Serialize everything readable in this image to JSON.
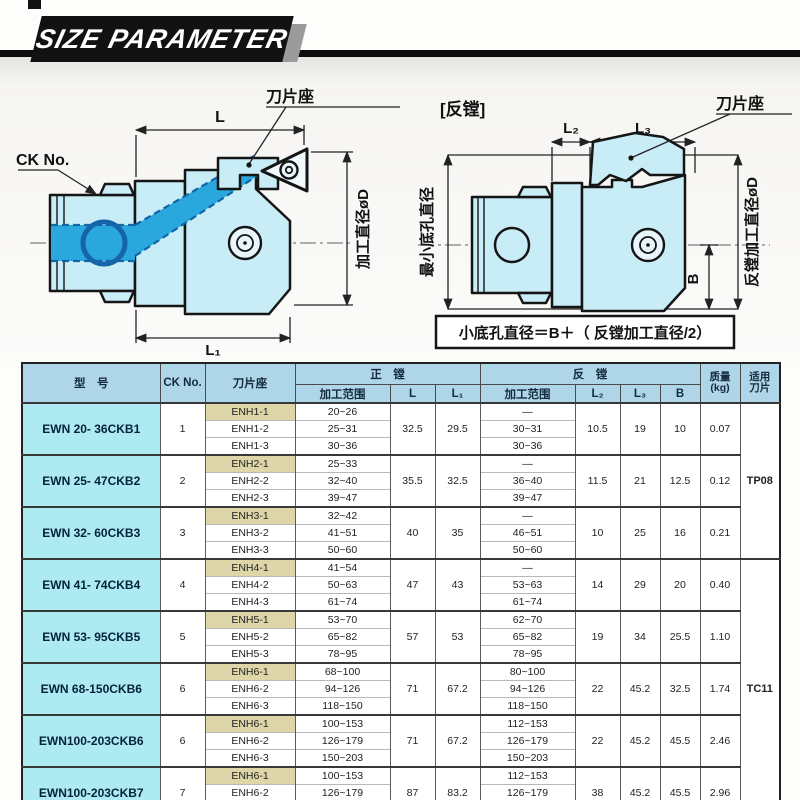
{
  "header": {
    "title": "SIZE PARAMETER"
  },
  "colors": {
    "accent_cyan": "#aeeaf2",
    "header_blue": "#aed6e8",
    "seat_tan": "#ded6a8",
    "tool_body_fill": "#c9edf7",
    "tool_highlight_blue": "#2aa7dc",
    "banner_black": "#111111"
  },
  "diagram_left": {
    "ck_label": "CK No.",
    "seat_label": "刀片座",
    "dim_l": "L",
    "dim_l1": "L₁",
    "dim_d": "加工直径øD"
  },
  "diagram_right": {
    "caption": "[反镗]",
    "dim_l2": "L₂",
    "dim_l3": "L₃",
    "seat_label": "刀片座",
    "dim_left": "最小底孔直径",
    "dim_right": "反镗加工直径øD",
    "dim_b": "B",
    "formula": "小底孔直径＝B＋（ 反镗加工直径/2）"
  },
  "table": {
    "headers": {
      "model": "型　号",
      "ck": "CK No.",
      "seat": "刀片座",
      "forward": "正　镗",
      "reverse": "反　镗",
      "range": "加工范围",
      "l": "L",
      "l1": "L₁",
      "l2": "L₂",
      "l3": "L₃",
      "b": "B",
      "weight_line1": "质量",
      "weight_line2": "(kg)",
      "insert_line1": "适用",
      "insert_line2": "刀片"
    },
    "insert_groups": [
      {
        "label": "TP08",
        "span": 3
      },
      {
        "label": "TC11",
        "span": 5
      }
    ],
    "rows": [
      {
        "model": "EWN 20- 36CKB1",
        "ck": "1",
        "seats": [
          "ENH1-1",
          "ENH1-2",
          "ENH1-3"
        ],
        "fwd": [
          "20~26",
          "25~31",
          "30~36"
        ],
        "l": "32.5",
        "l1": "29.5",
        "rev": [
          "—",
          "30~31",
          "30~36"
        ],
        "l2": "10.5",
        "l3": "19",
        "b": "10",
        "wt": "0.07"
      },
      {
        "model": "EWN 25- 47CKB2",
        "ck": "2",
        "seats": [
          "ENH2-1",
          "ENH2-2",
          "ENH2-3"
        ],
        "fwd": [
          "25~33",
          "32~40",
          "39~47"
        ],
        "l": "35.5",
        "l1": "32.5",
        "rev": [
          "—",
          "36~40",
          "39~47"
        ],
        "l2": "11.5",
        "l3": "21",
        "b": "12.5",
        "wt": "0.12"
      },
      {
        "model": "EWN 32- 60CKB3",
        "ck": "3",
        "seats": [
          "ENH3-1",
          "ENH3-2",
          "ENH3-3"
        ],
        "fwd": [
          "32~42",
          "41~51",
          "50~60"
        ],
        "l": "40",
        "l1": "35",
        "rev": [
          "—",
          "46~51",
          "50~60"
        ],
        "l2": "10",
        "l3": "25",
        "b": "16",
        "wt": "0.21"
      },
      {
        "model": "EWN 41- 74CKB4",
        "ck": "4",
        "seats": [
          "ENH4-1",
          "ENH4-2",
          "ENH4-3"
        ],
        "fwd": [
          "41~54",
          "50~63",
          "61~74"
        ],
        "l": "47",
        "l1": "43",
        "rev": [
          "—",
          "53~63",
          "61~74"
        ],
        "l2": "14",
        "l3": "29",
        "b": "20",
        "wt": "0.40"
      },
      {
        "model": "EWN 53- 95CKB5",
        "ck": "5",
        "seats": [
          "ENH5-1",
          "ENH5-2",
          "ENH5-3"
        ],
        "fwd": [
          "53~70",
          "65~82",
          "78~95"
        ],
        "l": "57",
        "l1": "53",
        "rev": [
          "62~70",
          "65~82",
          "78~95"
        ],
        "l2": "19",
        "l3": "34",
        "b": "25.5",
        "wt": "1.10"
      },
      {
        "model": "EWN 68-150CKB6",
        "ck": "6",
        "seats": [
          "ENH6-1",
          "ENH6-2",
          "ENH6-3"
        ],
        "fwd": [
          "68~100",
          "94~126",
          "118~150"
        ],
        "l": "71",
        "l1": "67.2",
        "rev": [
          "80~100",
          "94~126",
          "118~150"
        ],
        "l2": "22",
        "l3": "45.2",
        "b": "32.5",
        "wt": "1.74"
      },
      {
        "model": "EWN100-203CKB6",
        "ck": "6",
        "seats": [
          "ENH6-1",
          "ENH6-2",
          "ENH6-3"
        ],
        "fwd": [
          "100~153",
          "126~179",
          "150~203"
        ],
        "l": "71",
        "l1": "67.2",
        "rev": [
          "112~153",
          "126~179",
          "150~203"
        ],
        "l2": "22",
        "l3": "45.2",
        "b": "45.5",
        "wt": "2.46"
      },
      {
        "model": "EWN100-203CKB7",
        "ck": "7",
        "seats": [
          "ENH6-1",
          "ENH6-2",
          "ENH6-3"
        ],
        "fwd": [
          "100~153",
          "126~179",
          "150~203"
        ],
        "l": "87",
        "l1": "83.2",
        "rev": [
          "112~153",
          "126~179",
          "150~203"
        ],
        "l2": "38",
        "l3": "45.2",
        "b": "45.5",
        "wt": "2.96"
      }
    ]
  }
}
